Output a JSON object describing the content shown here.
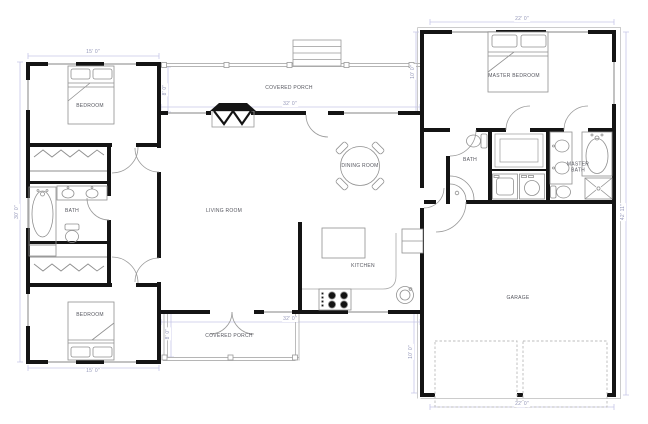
{
  "title": "House floor plan",
  "rooms": {
    "bedroom_top": {
      "label": "BEDROOM"
    },
    "bath_left": {
      "label": "BATH"
    },
    "bedroom_bottom": {
      "label": "BEDROOM"
    },
    "living": {
      "label": "LIVING ROOM"
    },
    "porch_top": {
      "label": "COVERED PORCH"
    },
    "porch_bottom": {
      "label": "COVERED PORCH"
    },
    "dining": {
      "label": "DINING ROOM"
    },
    "kitchen": {
      "label": "KITCHEN"
    },
    "master_bedroom": {
      "label": "MASTER BEDROOM"
    },
    "bath_right": {
      "label": "BATH"
    },
    "master_bath": {
      "label": "MASTER BATH"
    },
    "garage": {
      "label": "GARAGE"
    }
  },
  "dimensions": {
    "left_wing_width_top": "15' 0\"",
    "left_wing_height": "30' 0\"",
    "mid_width_top": "32' 0\"",
    "porch_top_depth": "8' 0\"",
    "porch_top_right_depth": "10' 0\"",
    "master_bedroom_width": "22' 0\"",
    "right_wing_height": "42' 11\"",
    "mid_width_bottom": "32' 0\"",
    "porch_bottom_depth": "8' 0\"",
    "garage_side_depth": "10' 0\"",
    "garage_width": "22' 0\"",
    "left_wing_width_bottom": "15' 0\""
  },
  "colors": {
    "wall": "#141414",
    "fixture": "#909090",
    "porch_line": "#b5b5b5",
    "dimension_line": "#c6c6e8",
    "dimension_text": "#9396b8",
    "room_text": "#55565e",
    "background": "#ffffff"
  }
}
